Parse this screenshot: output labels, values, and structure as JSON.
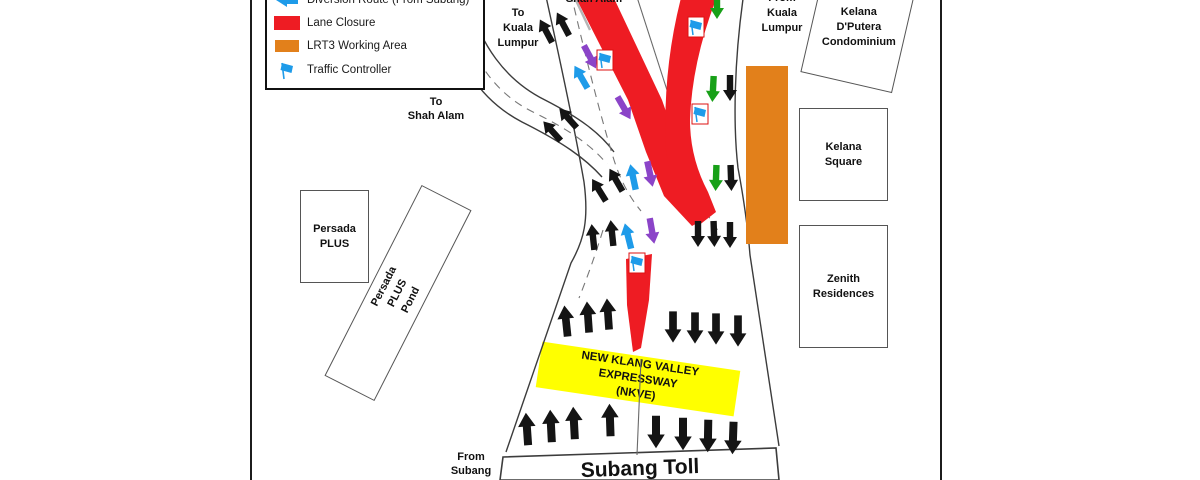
{
  "colors": {
    "red": "#EE1C23",
    "orange": "#E2801B",
    "yellow": "#FFFF00",
    "blue": "#1E9BE9",
    "purple": "#8B44C8",
    "green": "#18A018",
    "black": "#141414"
  },
  "legend": {
    "items": [
      {
        "label": "Diversion Route (From Subang)"
      },
      {
        "label": "Lane Closure"
      },
      {
        "label": "LRT3 Working Area"
      },
      {
        "label": "Traffic Controller"
      }
    ]
  },
  "labels": {
    "to_kuala_lumpur": "To\nKuala\nLumpur",
    "shah_alam_top": "Shah Alam",
    "from_kuala_lumpur": "From\nKuala\nLumpur",
    "to_shah_alam": "To\nShah Alam",
    "from_subang": "From\nSubang",
    "subang_toll": "Subang Toll",
    "nkve": "NEW KLANG VALLEY EXPRESSWAY\n(NKVE)"
  },
  "buildings": {
    "persada_plus": "Persada\nPLUS",
    "persada_plus_pond": "Persada PLUS\nPond",
    "kelana_dputera": "Kelana\nD'Putera\nCondominium",
    "kelana_square": "Kelana\nSquare",
    "zenith_residences": "Zenith\nResidences"
  },
  "map": {
    "arrows": [
      {
        "x": 546,
        "y": 31,
        "r": -28,
        "c": "black"
      },
      {
        "x": 563,
        "y": 24,
        "r": -28,
        "c": "black"
      },
      {
        "x": 590,
        "y": 57,
        "r": 152,
        "c": "purple"
      },
      {
        "x": 581,
        "y": 77,
        "r": -30,
        "c": "blue"
      },
      {
        "x": 624,
        "y": 108,
        "r": 150,
        "c": "purple"
      },
      {
        "x": 552,
        "y": 131,
        "r": -42,
        "c": "black"
      },
      {
        "x": 568,
        "y": 118,
        "r": -42,
        "c": "black"
      },
      {
        "x": 599,
        "y": 190,
        "r": -32,
        "c": "black"
      },
      {
        "x": 616,
        "y": 180,
        "r": -30,
        "c": "black"
      },
      {
        "x": 633,
        "y": 177,
        "r": -12,
        "c": "blue"
      },
      {
        "x": 650,
        "y": 174,
        "r": 168,
        "c": "purple"
      },
      {
        "x": 593,
        "y": 237,
        "r": -6,
        "c": "black"
      },
      {
        "x": 612,
        "y": 233,
        "r": -6,
        "c": "black"
      },
      {
        "x": 628,
        "y": 236,
        "r": -14,
        "c": "blue"
      },
      {
        "x": 652,
        "y": 231,
        "r": 170,
        "c": "purple"
      },
      {
        "x": 717,
        "y": 6,
        "r": 180,
        "c": "green"
      },
      {
        "x": 713,
        "y": 89,
        "r": 183,
        "c": "green"
      },
      {
        "x": 730,
        "y": 88,
        "r": 180,
        "c": "black"
      },
      {
        "x": 716,
        "y": 178,
        "r": 182,
        "c": "green"
      },
      {
        "x": 731,
        "y": 178,
        "r": 178,
        "c": "black"
      },
      {
        "x": 698,
        "y": 234,
        "r": 180,
        "c": "black"
      },
      {
        "x": 714,
        "y": 234,
        "r": 178,
        "c": "black"
      },
      {
        "x": 730,
        "y": 235,
        "r": 180,
        "c": "black"
      },
      {
        "x": 566,
        "y": 321,
        "r": -6,
        "c": "black",
        "s": 1.2
      },
      {
        "x": 588,
        "y": 317,
        "r": -4,
        "c": "black",
        "s": 1.2
      },
      {
        "x": 608,
        "y": 314,
        "r": -4,
        "c": "black",
        "s": 1.2
      },
      {
        "x": 673,
        "y": 327,
        "r": 180,
        "c": "black",
        "s": 1.2
      },
      {
        "x": 695,
        "y": 328,
        "r": 180,
        "c": "black",
        "s": 1.2
      },
      {
        "x": 716,
        "y": 329,
        "r": 180,
        "c": "black",
        "s": 1.2
      },
      {
        "x": 738,
        "y": 331,
        "r": 180,
        "c": "black",
        "s": 1.2
      },
      {
        "x": 527,
        "y": 429,
        "r": -4,
        "c": "black",
        "s": 1.25
      },
      {
        "x": 551,
        "y": 426,
        "r": -3,
        "c": "black",
        "s": 1.25
      },
      {
        "x": 574,
        "y": 423,
        "r": -3,
        "c": "black",
        "s": 1.25
      },
      {
        "x": 610,
        "y": 420,
        "r": -2,
        "c": "black",
        "s": 1.25
      },
      {
        "x": 656,
        "y": 432,
        "r": 180,
        "c": "black",
        "s": 1.25
      },
      {
        "x": 683,
        "y": 434,
        "r": 180,
        "c": "black",
        "s": 1.25
      },
      {
        "x": 708,
        "y": 436,
        "r": 181,
        "c": "black",
        "s": 1.25
      },
      {
        "x": 733,
        "y": 438,
        "r": 182,
        "c": "black",
        "s": 1.25
      }
    ],
    "flags": [
      {
        "x": 605,
        "y": 60
      },
      {
        "x": 696,
        "y": 27
      },
      {
        "x": 700,
        "y": 114
      },
      {
        "x": 637,
        "y": 263
      }
    ]
  }
}
